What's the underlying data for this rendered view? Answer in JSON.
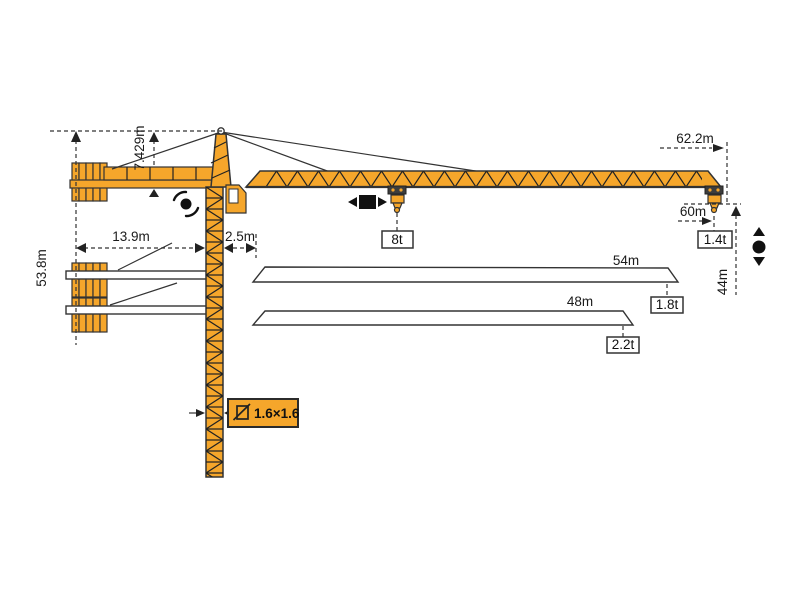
{
  "diagram_type": "tower-crane-specification-diagram",
  "dimensions": {
    "height_total": "53.8m",
    "tower_head": "7.429m",
    "counterjib_radius": "13.9m",
    "rear_offset": "2.5m",
    "max_radius": "62.2m",
    "tip_radius": "60m",
    "tip_capacity": "1.4t",
    "hoist_height": "44m",
    "max_capacity": "8t",
    "jib_option_1_length": "54m",
    "jib_option_1_capacity": "1.8t",
    "jib_option_2_length": "48m",
    "jib_option_2_capacity": "2.2t",
    "mast_cross_section": "1.6×1.6"
  },
  "icons": {
    "slewing": "slewing-rotation-icon",
    "trolley": "trolley-travel-icon",
    "hoist": "hoist-up-down-icon",
    "section": "mast-cross-section-icon"
  },
  "colors": {
    "crane_orange": "#F5A62B",
    "outline": "#333333",
    "line": "#222222",
    "background": "#FFFFFF"
  }
}
